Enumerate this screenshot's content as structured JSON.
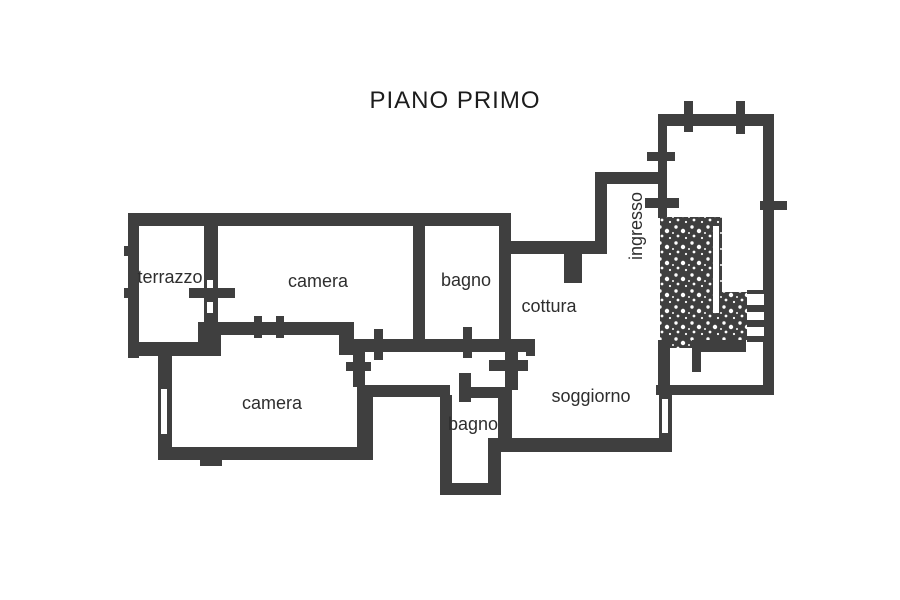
{
  "title": "PIANO PRIMO",
  "rooms": {
    "terrazzo": "terrazzo",
    "camera_top": "camera",
    "bagno_top": "bagno",
    "cottura": "cottura",
    "ingresso": "ingresso",
    "camera_bottom": "camera",
    "bagno_bottom": "bagno",
    "soggiorno": "soggiorno"
  },
  "colors": {
    "wall": "#3f3f3f",
    "text": "#2e2e2e",
    "title_text": "#1c1c1c",
    "background": "#ffffff"
  }
}
